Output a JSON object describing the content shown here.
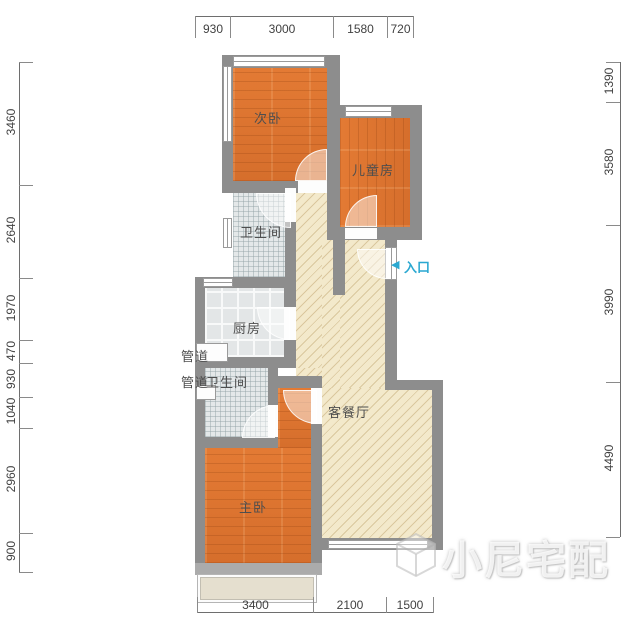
{
  "rooms": {
    "secondary_bedroom": "次卧",
    "children_room": "儿童房",
    "bathroom_upper": "卫生间",
    "kitchen": "厨房",
    "duct_upper": "管道",
    "duct_lower": "管道",
    "bathroom_lower": "卫生间",
    "living_dining": "客餐厅",
    "master_bedroom": "主卧"
  },
  "entrance": {
    "arrow": "◀",
    "label": "入口"
  },
  "dimensions": {
    "top": [
      "930",
      "3000",
      "1580",
      "720"
    ],
    "bottom": [
      "3400",
      "2100",
      "1500"
    ],
    "left": [
      "3460",
      "2640",
      "1970",
      "470",
      "930",
      "1040",
      "2960",
      "900"
    ],
    "right": [
      "1390",
      "3580",
      "3990",
      "4490"
    ]
  },
  "watermark": {
    "text": "小尼宅配"
  },
  "colors": {
    "wall": "#8D8D8D",
    "wood_floor": "#DD7430",
    "tile_floor": "#E4E8E9",
    "living_floor": "#F3E9CB",
    "entrance_accent": "#2BA8D1"
  }
}
